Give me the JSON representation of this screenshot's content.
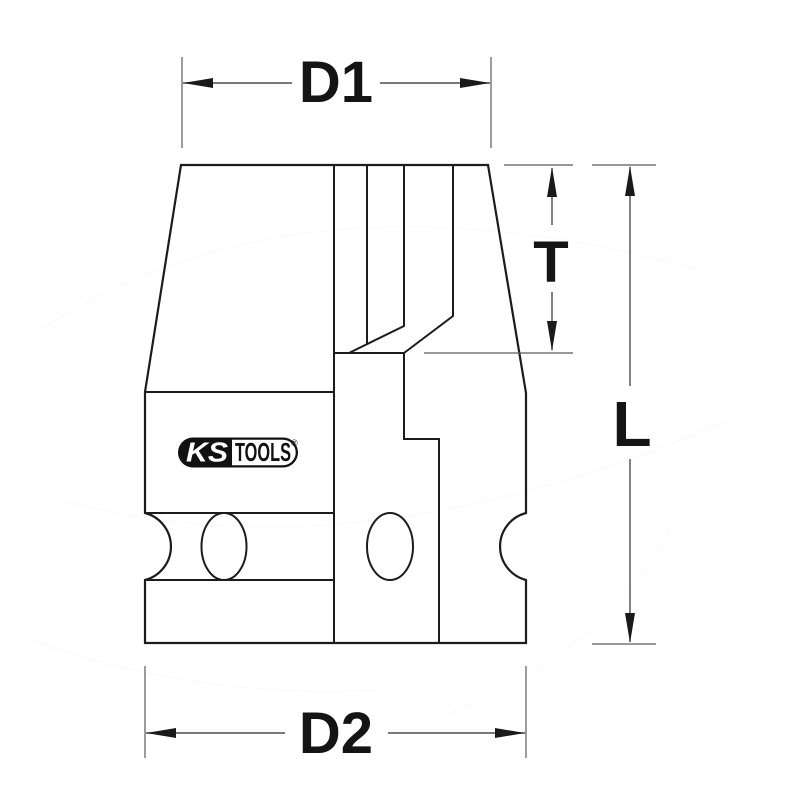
{
  "drawing": {
    "title": "KS Tools impact socket technical drawing",
    "background_color": "#ffffff",
    "outline_color": "#1c1c1c",
    "dimension_color": "#4d4d4d",
    "label_color": "#141414",
    "labels": {
      "top_width": "D1",
      "bottom_width": "D2",
      "insert_depth": "T",
      "total_length": "L"
    },
    "logo": {
      "left_text": "KS",
      "right_text": "TOOLS",
      "registered_mark": "®",
      "pill_color": "#111111",
      "left_text_color": "#ffffff",
      "right_text_color": "#111111"
    }
  }
}
